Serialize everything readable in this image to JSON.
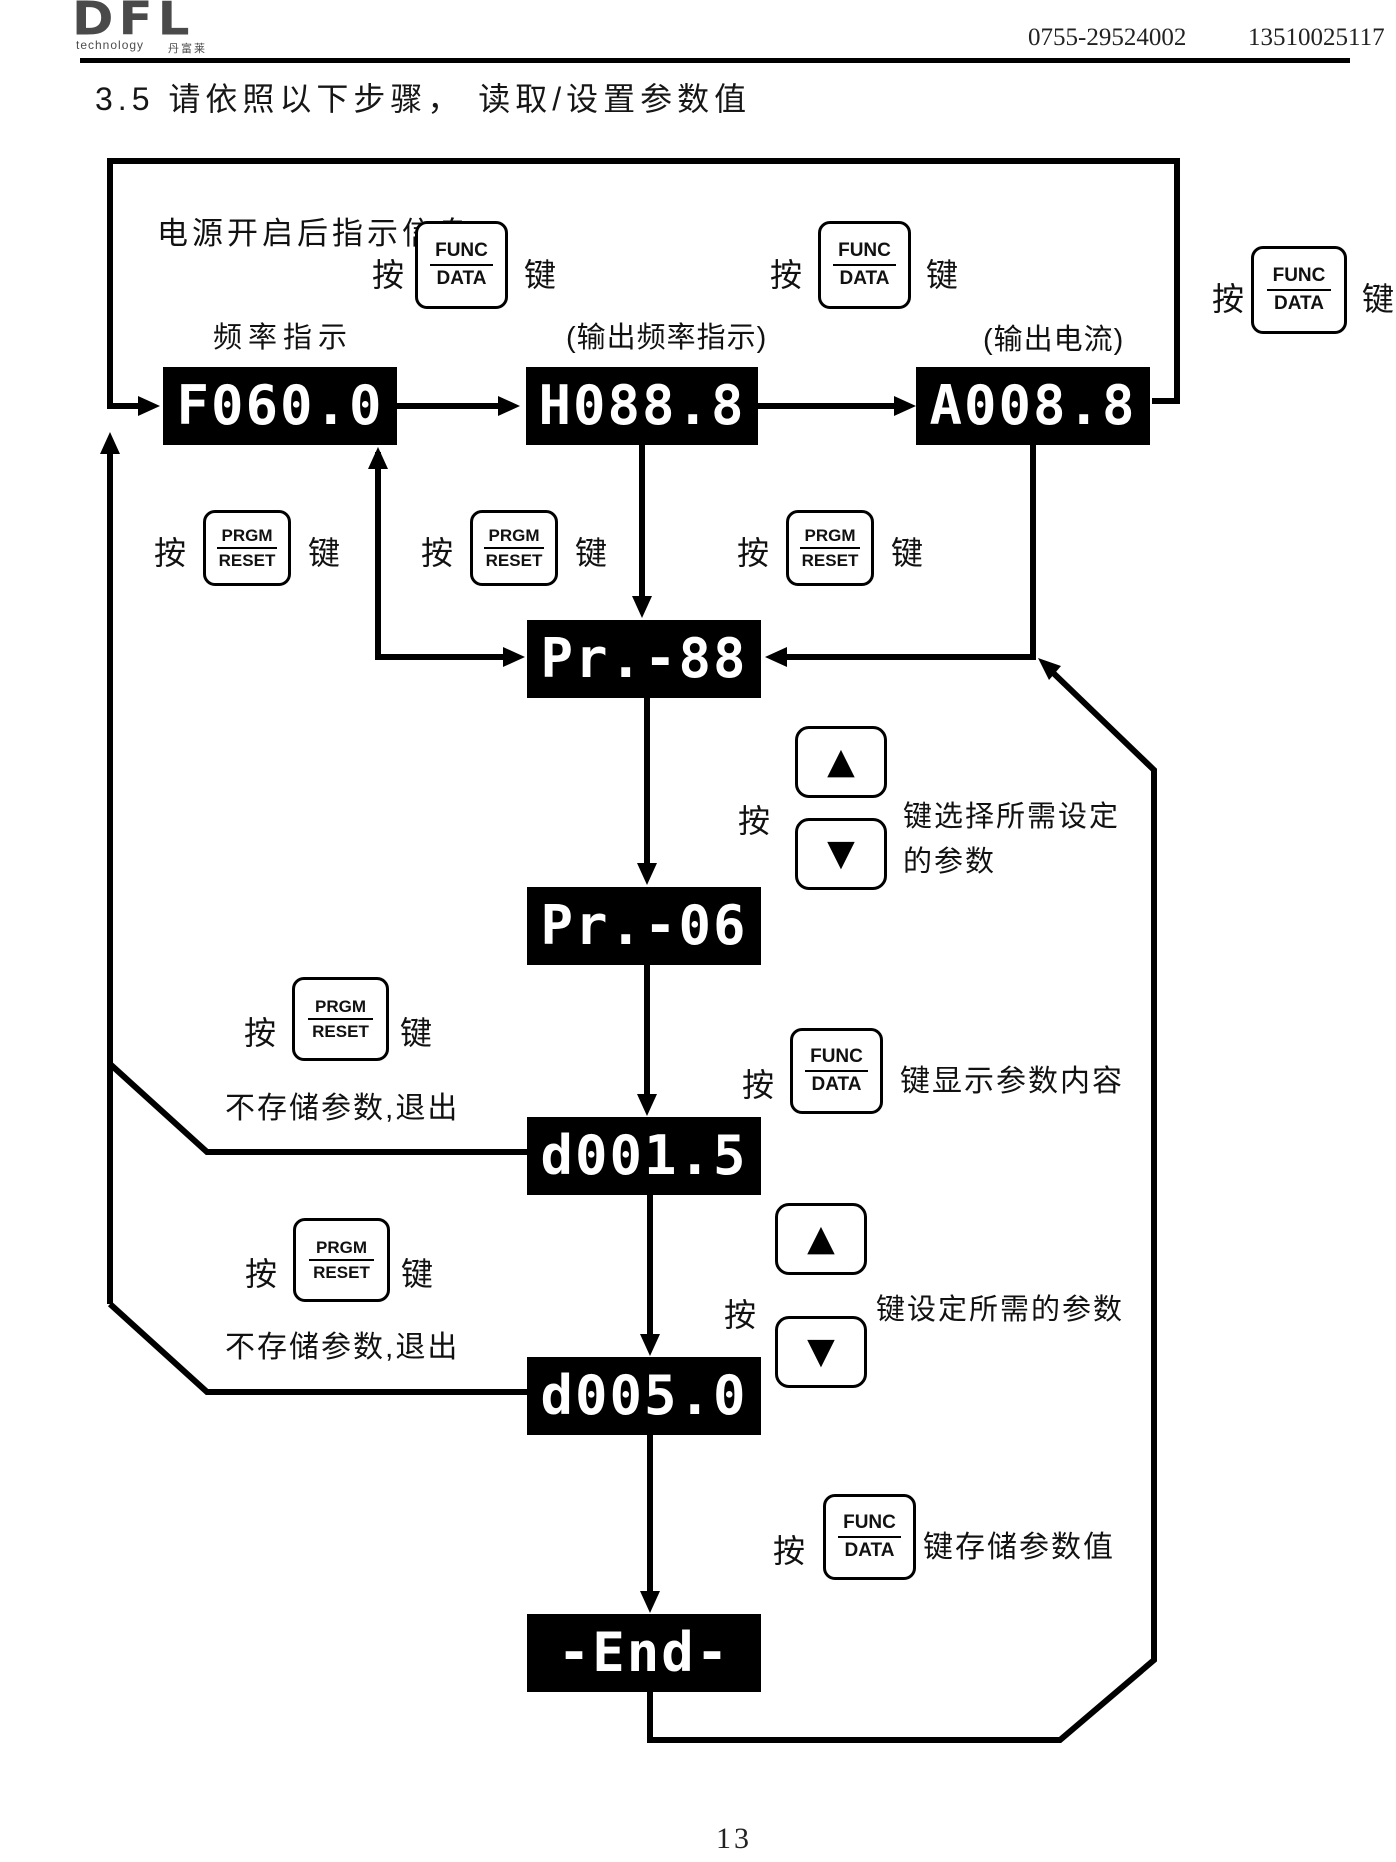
{
  "header": {
    "logo_text": "DFL",
    "logo_sub": "technology",
    "logo_cn": "丹富莱",
    "phone1": "0755-29524002",
    "phone2": "13510025117"
  },
  "title": "3.5 请依照以下步骤， 读取/设置参数值",
  "flow": {
    "power_on_label": "电源开启后指示信息",
    "press": "按",
    "key": "键",
    "func_btn": {
      "top": "FUNC",
      "bottom": "DATA"
    },
    "prgm_btn": {
      "top": "PRGM",
      "bottom": "RESET"
    },
    "up_icon": "▲",
    "down_icon": "▼",
    "labels": {
      "freq": "频率指示",
      "out_freq": "(输出频率指示)",
      "out_current": "(输出电流)"
    },
    "displays": {
      "freq": "F060.0",
      "out_freq": "H088.8",
      "out_current": "A008.8",
      "param_group": "Pr.-88",
      "param_sel": "Pr.-06",
      "value_read": "d001.5",
      "value_set": "d005.0",
      "end": "-End-"
    },
    "texts": {
      "select_line1": "键选择所需设定",
      "select_line2": "的参数",
      "show_param": "键显示参数内容",
      "no_save_exit_1": "不存储参数,退出",
      "set_param": "键设定所需的参数",
      "no_save_exit_2": "不存储参数,退出",
      "save_param": "键存储参数值"
    }
  },
  "footer": {
    "page_number": "13"
  }
}
